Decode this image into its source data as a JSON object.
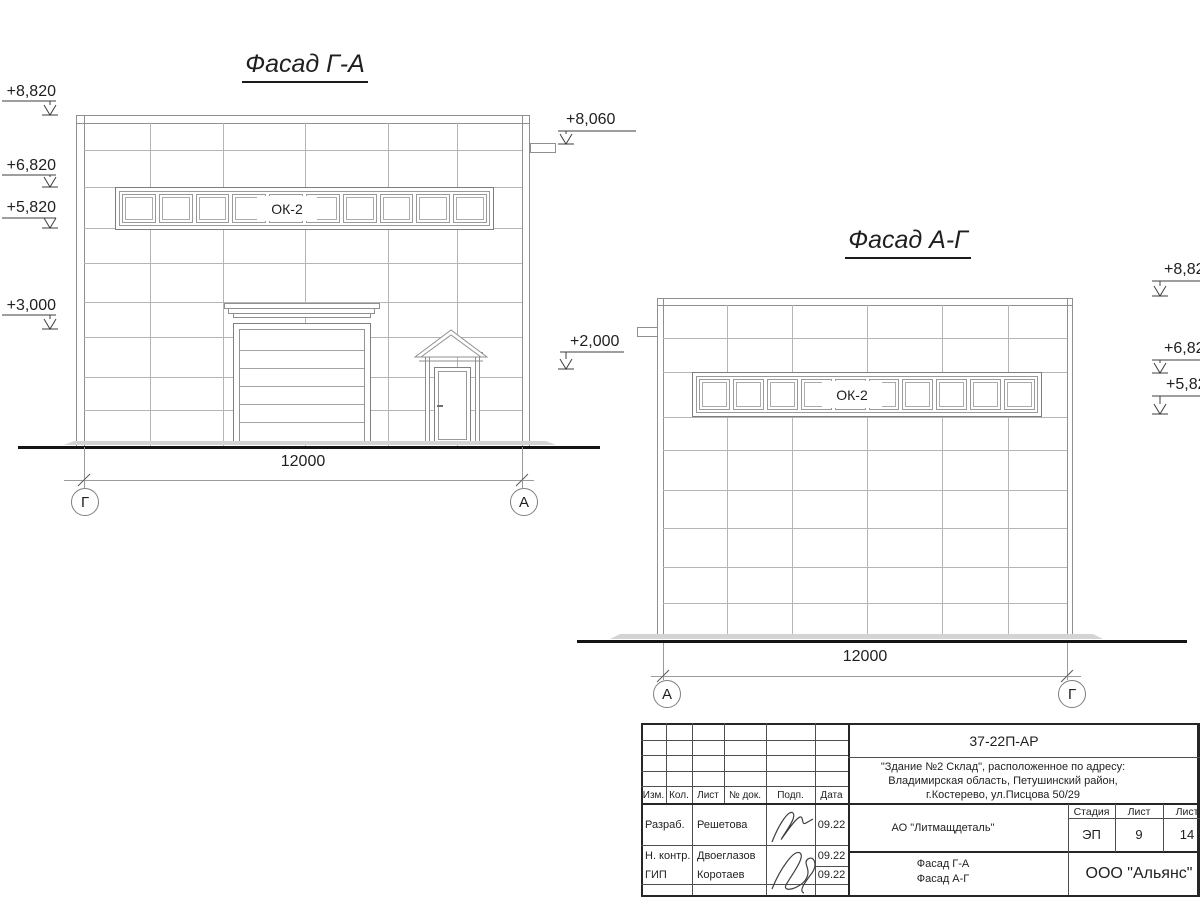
{
  "facade_ga": {
    "title": "Фасад Г-А",
    "marks_left": [
      {
        "value": "+8,820"
      },
      {
        "value": "+6,820"
      },
      {
        "value": "+5,820"
      },
      {
        "value": "+3,000"
      }
    ],
    "marks_right": [
      {
        "value": "+8,060"
      },
      {
        "value": "+2,000"
      }
    ],
    "window_label": "ОК-2",
    "dimension": "12000",
    "axis_left": "Г",
    "axis_right": "А"
  },
  "facade_ag": {
    "title": "Фасад А-Г",
    "marks_right": [
      {
        "value": "+8,82"
      },
      {
        "value": "+6,82"
      },
      {
        "value": "+5,82"
      }
    ],
    "window_label": "ОК-2",
    "dimension": "12000",
    "axis_left": "А",
    "axis_right": "Г"
  },
  "titleblock": {
    "doc_number": "37-22П-АР",
    "project_line1": "\"Здание №2 Склад\", расположенное по адресу:",
    "project_line2": "Владимирская область, Петушинский район,",
    "project_line3": "г.Костерево, ул.Писцова 50/29",
    "client": "АО \"Литмащдеталь\"",
    "sheet_name_line1": "Фасад Г-А",
    "sheet_name_line2": "Фасад А-Г",
    "company": "ООО \"Альянс\"",
    "stage_label": "Стадия",
    "sheet_label": "Лист",
    "sheets_label": "Лист",
    "stage": "ЭП",
    "sheet": "9",
    "sheets": "14",
    "rev_headers": {
      "izm": "Изм.",
      "kol": "Кол.",
      "list": "Лист",
      "doc": "№ док.",
      "podp": "Подп.",
      "data": "Дата"
    },
    "signers": [
      {
        "role": "Разраб.",
        "name": "Решетова",
        "date": "09.22"
      },
      {
        "role": "Н. контр.",
        "name": "Двоеглазов",
        "date": "09.22"
      },
      {
        "role": "ГИП",
        "name": "Коротаев",
        "date": "09.22"
      }
    ]
  }
}
